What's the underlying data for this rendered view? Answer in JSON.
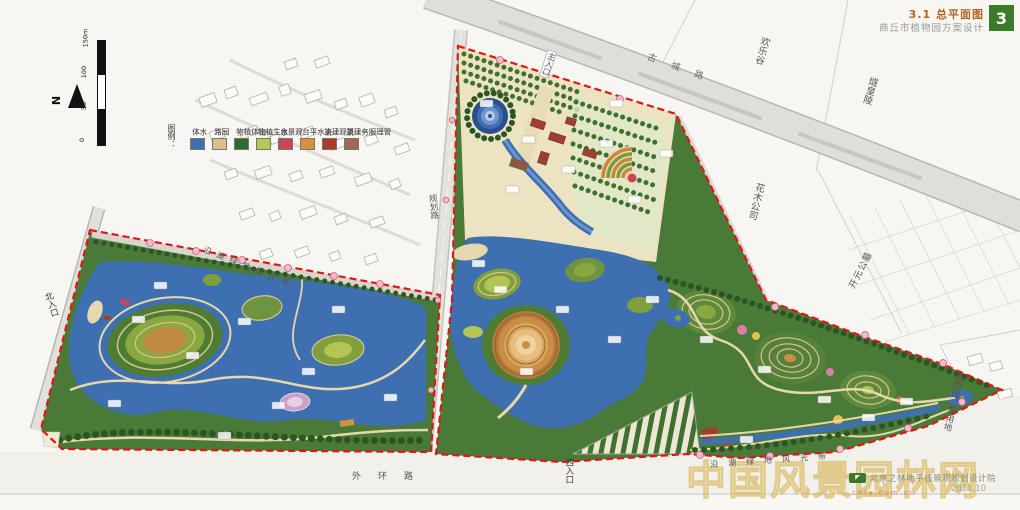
{
  "header": {
    "title": "3.1 总平面图",
    "subtitle": "商丘市植物园方案设计",
    "badge": "3"
  },
  "legend": {
    "caption": "图例：",
    "items": [
      {
        "label": "水体",
        "color": "#3e6fb0"
      },
      {
        "label": "园路",
        "color": "#d9c089"
      },
      {
        "label": "山体植物",
        "color": "#2f6b2f"
      },
      {
        "label": "水生植物",
        "color": "#b3c94f"
      },
      {
        "label": "观景台",
        "color": "#cc4455"
      },
      {
        "label": "亲水平台",
        "color": "#d8903e"
      },
      {
        "label": "景观建筑",
        "color": "#a83a28"
      },
      {
        "label": "管理服务建筑",
        "color": "#a06a50"
      }
    ]
  },
  "scalebar": {
    "ticks": [
      "0",
      "50",
      "100",
      "150m"
    ],
    "north": "N"
  },
  "roads": {
    "gucheng": "古城路",
    "guihua": "规划路",
    "waihuan": "外环路"
  },
  "entrances": {
    "main": "主入口",
    "north": "北入口",
    "west": "西入口"
  },
  "surroundings": {
    "huanlegu": "欢乐谷",
    "suihuangling": "燧皇陵",
    "huamu_company": "花木公司",
    "kaiyuan_cemetery": "开元公墓",
    "phase2_land": "植物园二期用地"
  },
  "scenic_belts": {
    "northwest": "沿湖绿地风光带",
    "southeast": "沿湖绿地风光带"
  },
  "footer": {
    "firm": "北京之林地平线景观规划设计院",
    "date": "2011.10"
  },
  "watermark": {
    "site_name": "中国风景园林网",
    "url": "chla.com.cn"
  }
}
